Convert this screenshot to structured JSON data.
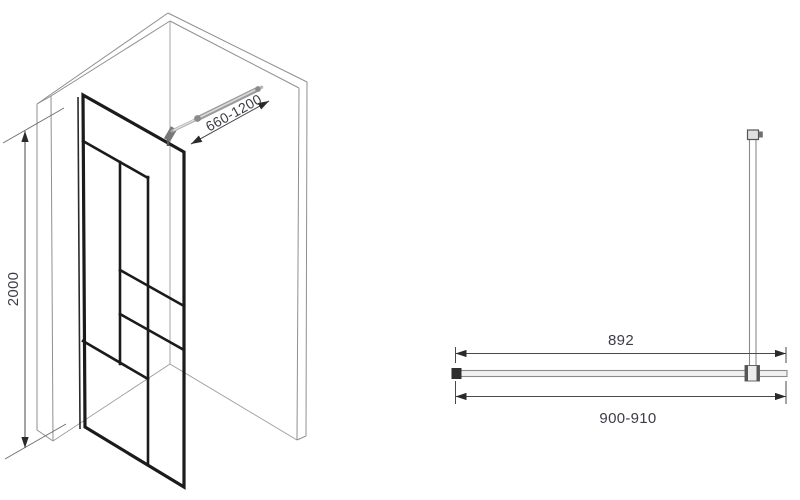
{
  "diagram": {
    "title": "Walk-in shower glass screen technical drawing",
    "isometric_view": {
      "height_dimension": "2000",
      "support_bar_dimension": "660-1200"
    },
    "plan_view": {
      "glass_width_dimension": "892",
      "overall_width_dimension": "900-910"
    },
    "colors": {
      "background": "#ffffff",
      "frame": "#1b1b1b",
      "wall_line": "#8f8f8f",
      "dimension_line": "#4a4a4a",
      "dimension_text": "#3d3c46",
      "support_bar": "#9b9b9b"
    }
  }
}
